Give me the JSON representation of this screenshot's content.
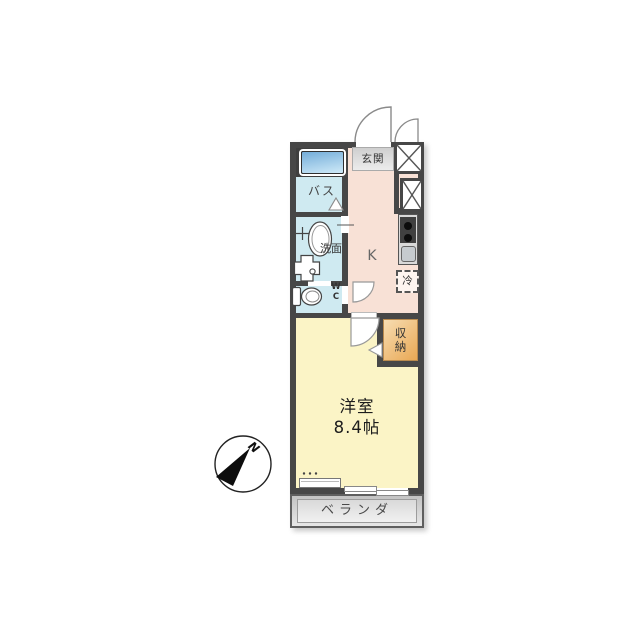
{
  "floorplan": {
    "compass": {
      "north_label": "N"
    },
    "rooms": {
      "genkan": {
        "label": "玄関"
      },
      "bath": {
        "label": "バス"
      },
      "washroom": {
        "label": "洗面"
      },
      "toilet": {
        "label": "W\nC"
      },
      "kitchen": {
        "label": "K"
      },
      "refrigerator": {
        "label": "冷"
      },
      "storage": {
        "label": "収納"
      },
      "main_room": {
        "name": "洋室",
        "size": "8.4帖"
      },
      "balcony": {
        "label": "ベランダ"
      }
    }
  },
  "colors": {
    "wall": "#474747",
    "wet": "#cfeaf1",
    "hall": "#f8e1d6",
    "room": "#fbf4c6",
    "genkan_dark": "#cfcfcf",
    "genkan_light": "#ececec",
    "storage_light": "#f7ddb2",
    "storage_dark": "#e9a854",
    "tub_dark": "#74add9",
    "tub_light": "#cfeaf8",
    "balcony_dark": "#c3c3c3",
    "balcony_light": "#e7e7e7"
  }
}
